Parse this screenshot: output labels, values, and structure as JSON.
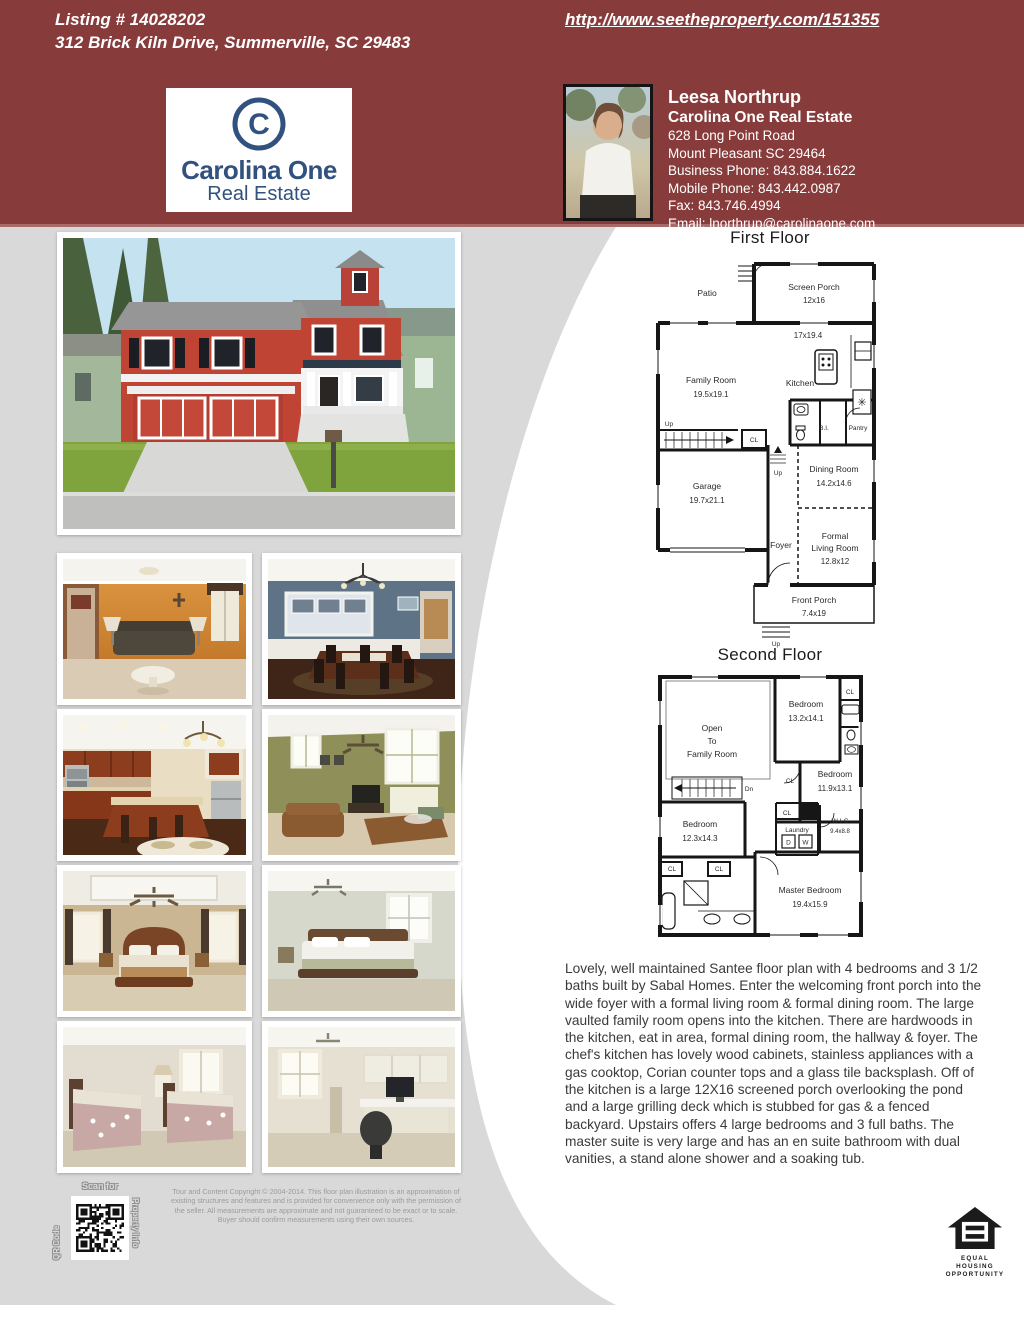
{
  "colors": {
    "maroon": "#873B3B",
    "panel_gray": "#D9D9D9",
    "navy": "#31517E"
  },
  "header": {
    "listing_line1": "Listing # 14028202",
    "listing_line2": "312 Brick Kiln Drive, Summerville, SC 29483",
    "url": "http://www.seetheproperty.com/151355",
    "logo": {
      "monogram": "C",
      "brand": "Carolina One",
      "subtitle": "Real Estate"
    },
    "agent": {
      "name": "Leesa Northrup",
      "company": "Carolina One Real Estate",
      "address_line1": "628 Long Point Road",
      "address_line2": "Mount Pleasant SC 29464",
      "business_phone": "Business Phone: 843.884.1622",
      "mobile_phone": "Mobile Phone: 843.442.0987",
      "fax": "Fax: 843.746.4994",
      "email": "Email: lnorthrup@carolinaone.com"
    }
  },
  "floorplans": {
    "first": {
      "title": "First Floor",
      "patio": "Patio",
      "screen_porch": "Screen Porch",
      "screen_porch_dim": "12x16",
      "kitchen": "Kitchen",
      "kitchen_dim": "17x19.4",
      "family_room": "Family Room",
      "family_room_dim": "19.5x19.1",
      "garage": "Garage",
      "garage_dim": "19.7x21.1",
      "dining_room": "Dining Room",
      "dining_room_dim": "14.2x14.6",
      "foyer": "Foyer",
      "formal": "Formal",
      "living_room": "Living Room",
      "living_room_dim": "12.8x12",
      "front_porch": "Front Porch",
      "front_porch_dim": "7.4x19",
      "bi": "B.I.",
      "pantry": "Pantry"
    },
    "second": {
      "title": "Second Floor",
      "open1": "Open",
      "open2": "To",
      "open3": "Family Room",
      "bedroom1": "Bedroom",
      "bedroom1_dim": "13.2x14.1",
      "bedroom2": "Bedroom",
      "bedroom2_dim": "11.9x13.1",
      "bedroom3": "Bedroom",
      "bedroom3_dim": "12.3x14.3",
      "master": "Master Bedroom",
      "master_dim": "19.4x15.9",
      "wic": "W-I-C",
      "wic_dim": "9.4x8.8",
      "laundry": "Laundry",
      "d": "D",
      "w": "W",
      "dn": "Dn"
    },
    "labels": {
      "cl": "CL",
      "up": "Up"
    }
  },
  "description": "Lovely, well maintained Santee floor plan with 4 bedrooms and 3 1/2 baths built by Sabal Homes. Enter the welcoming front porch into the wide foyer with a formal living room & formal dining room. The large vaulted family room opens into the kitchen. There are hardwoods in the kitchen, eat in area, formal dining room, the hallway & foyer. The chef's kitchen has lovely wood cabinets, stainless appliances with a gas cooktop, Corian counter tops and a glass tile backsplash. Off of the kitchen is a large 12X16 screened porch overlooking the pond and a large grilling deck which is stubbed for gas & a fenced backyard. Upstairs offers 4 large bedrooms and 3 full baths. The master suite is very large and has an en suite bathroom with dual vanities, a stand alone shower and a soaking tub.",
  "qr": {
    "scan_for": "Scan for",
    "left_label": "QR Code",
    "right_label": "Property Info"
  },
  "copyright": "Tour and Content Copyright © 2004-2014. This floor plan illustration is an approximation of existing structures and features and is provided for convenience only with the permission of the seller. All measurements are approximate and not guaranteed to be exact or to scale. Buyer should confirm measurements using their own sources.",
  "equal_housing": {
    "line1": "EQUAL HOUSING",
    "line2": "OPPORTUNITY"
  },
  "photos": {
    "main": "exterior-front",
    "grid": [
      "living-room",
      "dining-room",
      "kitchen",
      "family-room",
      "master-bedroom",
      "bedroom",
      "guest-bedroom",
      "office"
    ]
  }
}
